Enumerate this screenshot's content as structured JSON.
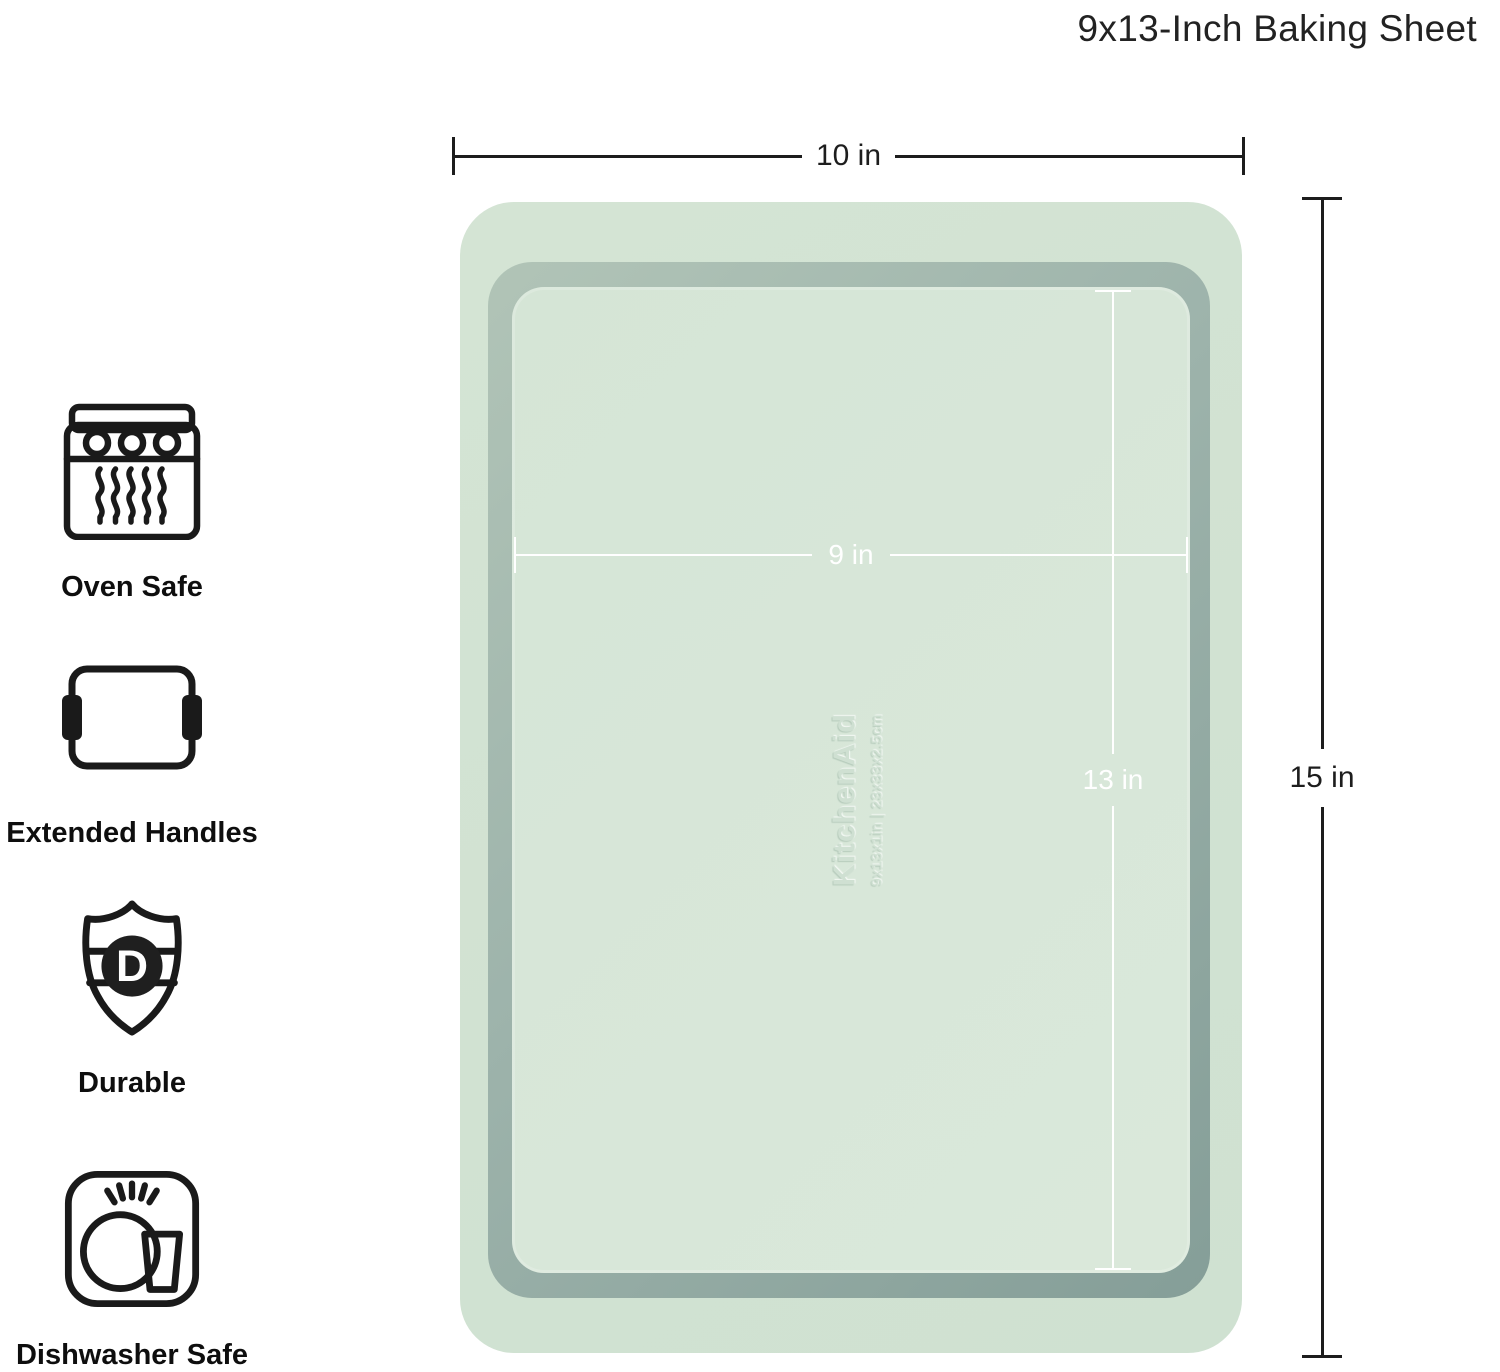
{
  "header": {
    "title": "9x13-Inch Baking Sheet"
  },
  "dimensions": {
    "outer_width_label": "10 in",
    "outer_height_label": "15 in",
    "inner_width_label": "9 in",
    "inner_length_label": "13 in"
  },
  "tray": {
    "embossed_brand": "KitchenAid",
    "embossed_size": "9x13x1in | 23x33x2.5cm",
    "colors": {
      "flange": "#d1e2d2",
      "wall_light": "#b1c4b7",
      "wall_dark": "#859e98",
      "floor": "#d7e6d8",
      "inner_dimension_line": "#ffffff",
      "outer_dimension_line": "#1d1d1d"
    }
  },
  "features": [
    {
      "icon": "oven-icon",
      "label": "Oven Safe"
    },
    {
      "icon": "extended-handles-icon",
      "label": "Extended Handles"
    },
    {
      "icon": "durable-shield-icon",
      "label": "Durable",
      "badge_letter": "D"
    },
    {
      "icon": "dishwasher-icon",
      "label": "Dishwasher Safe"
    }
  ]
}
